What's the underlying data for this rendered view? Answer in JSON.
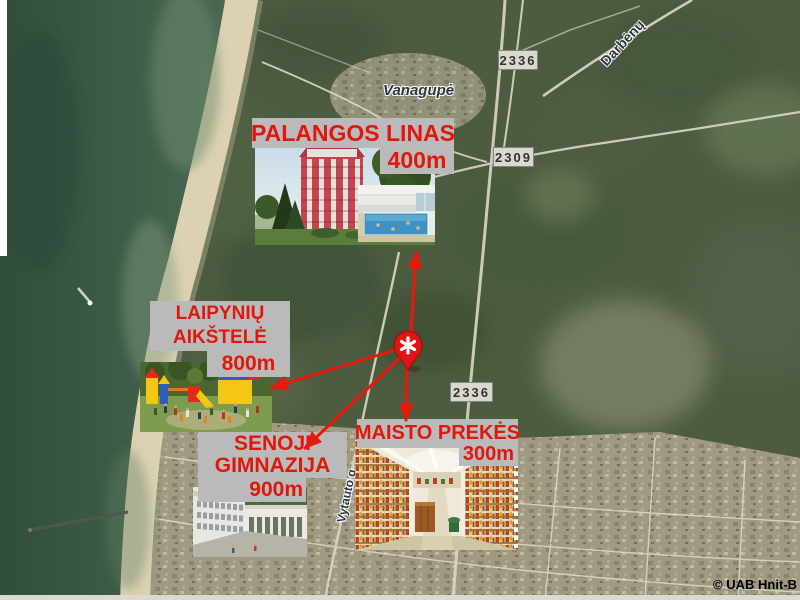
{
  "map": {
    "place_labels": {
      "vanagupe": "Vanagupė",
      "darbenu_road": "Darbėnų",
      "vytauto_street": "Vytauto g."
    },
    "road_signs": {
      "top": "2336",
      "middle": "2309",
      "lower": "2336"
    },
    "copyright": "© UAB Hnit-B"
  },
  "pois": {
    "palangos_linas": {
      "name": "PALANGOS LINAS",
      "distance": "400m"
    },
    "laipyniu_aikstele": {
      "name_line1": "LAIPYNIŲ",
      "name_line2": "AIKŠTELĖ",
      "distance": "800m"
    },
    "senoji_gimnazija": {
      "name_line1": "SENOJI",
      "name_line2": "GIMNAZIJA",
      "distance": "900m"
    },
    "maisto_prekes": {
      "name": "MAISTO PREKĖS",
      "distance": "300m"
    }
  },
  "icons": {
    "marker": "map-pin-asterisk",
    "arrows": "red-direction-arrows"
  },
  "colors": {
    "label_text": "#e0170b",
    "label_bg": "#bababa",
    "arrow": "#e8180c",
    "marker_fill": "#e01414",
    "marker_border": "#9c0c0c",
    "sign_bg": "#dad8d0",
    "sign_border": "#85857f",
    "sign_text": "#33332f",
    "map_label_text": "#2c3840",
    "copyright_text": "#000000",
    "sea": "#3b5a48",
    "beach": "#dcd2b3",
    "forest": "#4d5c41"
  }
}
